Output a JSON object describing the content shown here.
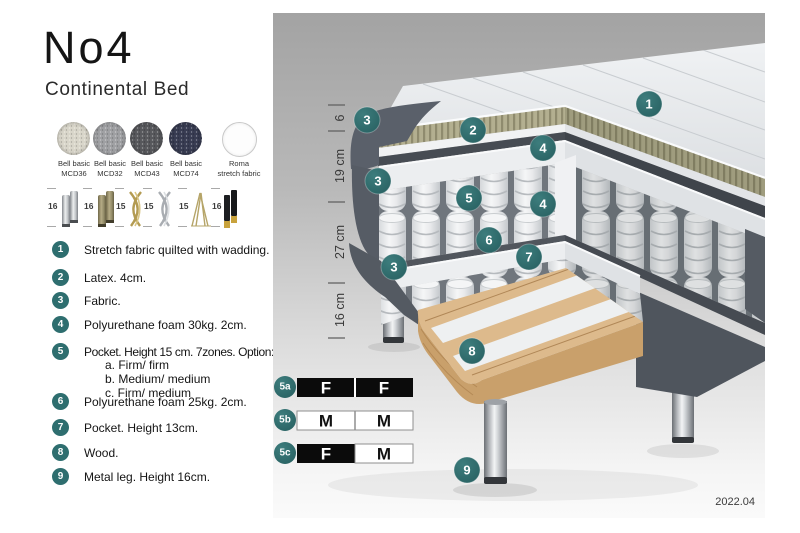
{
  "title": "No4",
  "subtitle": "Continental Bed",
  "swatches": [
    {
      "line1": "Bell basic",
      "line2": "MCD36",
      "color": "#d9d6ca"
    },
    {
      "line1": "Bell basic",
      "line2": "MCD32",
      "color": "#9fa0a3"
    },
    {
      "line1": "Bell basic",
      "line2": "MCD43",
      "color": "#57585c"
    },
    {
      "line1": "Bell basic",
      "line2": "MCD74",
      "color": "#383c52"
    },
    {
      "line1": "Roma",
      "line2": "stretch fabric",
      "color": "#fdfdfd"
    }
  ],
  "legs": [
    {
      "num": "16",
      "style": "chrome cylinder"
    },
    {
      "num": "16",
      "style": "brass cylinder"
    },
    {
      "num": "15",
      "style": "gold twist"
    },
    {
      "num": "15",
      "style": "silver twist"
    },
    {
      "num": "15",
      "style": "hairpin"
    },
    {
      "num": "16",
      "style": "black with gold tip"
    }
  ],
  "list": [
    {
      "num": "1",
      "text": "Stretch fabric quilted with wadding."
    },
    {
      "num": "2",
      "text": "Latex. 4cm."
    },
    {
      "num": "3",
      "text": "Fabric."
    },
    {
      "num": "4",
      "text": "Polyurethane foam 30kg. 2cm."
    },
    {
      "num": "5",
      "text": "Pocket. Height 15 cm. 7zones. Option:",
      "options": [
        "a. Firm/ firm",
        "b. Medium/ medium",
        "c. Firm/ medium"
      ]
    },
    {
      "num": "6",
      "text": "Polyurethane foam 25kg. 2cm."
    },
    {
      "num": "7",
      "text": "Pocket. Height 13cm."
    },
    {
      "num": "8",
      "text": "Wood."
    },
    {
      "num": "9",
      "text": "Metal leg. Height 16cm."
    }
  ],
  "diagram": {
    "dimensions": [
      "6",
      "19 cm",
      "27 cm",
      "16 cm"
    ],
    "callouts": [
      "1",
      "2",
      "3",
      "4",
      "3",
      "5",
      "4",
      "6",
      "7",
      "3",
      "8",
      "9"
    ],
    "firmness": [
      {
        "id": "5a",
        "left": "F",
        "right": "F"
      },
      {
        "id": "5b",
        "left": "M",
        "right": "M"
      },
      {
        "id": "5c",
        "left": "F",
        "right": "M"
      }
    ],
    "version": "2022.04"
  },
  "colors": {
    "accent_teal": "#2e6e6f",
    "latex_khaki": "#b3af90",
    "frame_gray": "#565c65",
    "wood": "#ddba8c",
    "firm_cell_black": "#0b0b0b",
    "medium_cell_white": "#ffffff"
  }
}
